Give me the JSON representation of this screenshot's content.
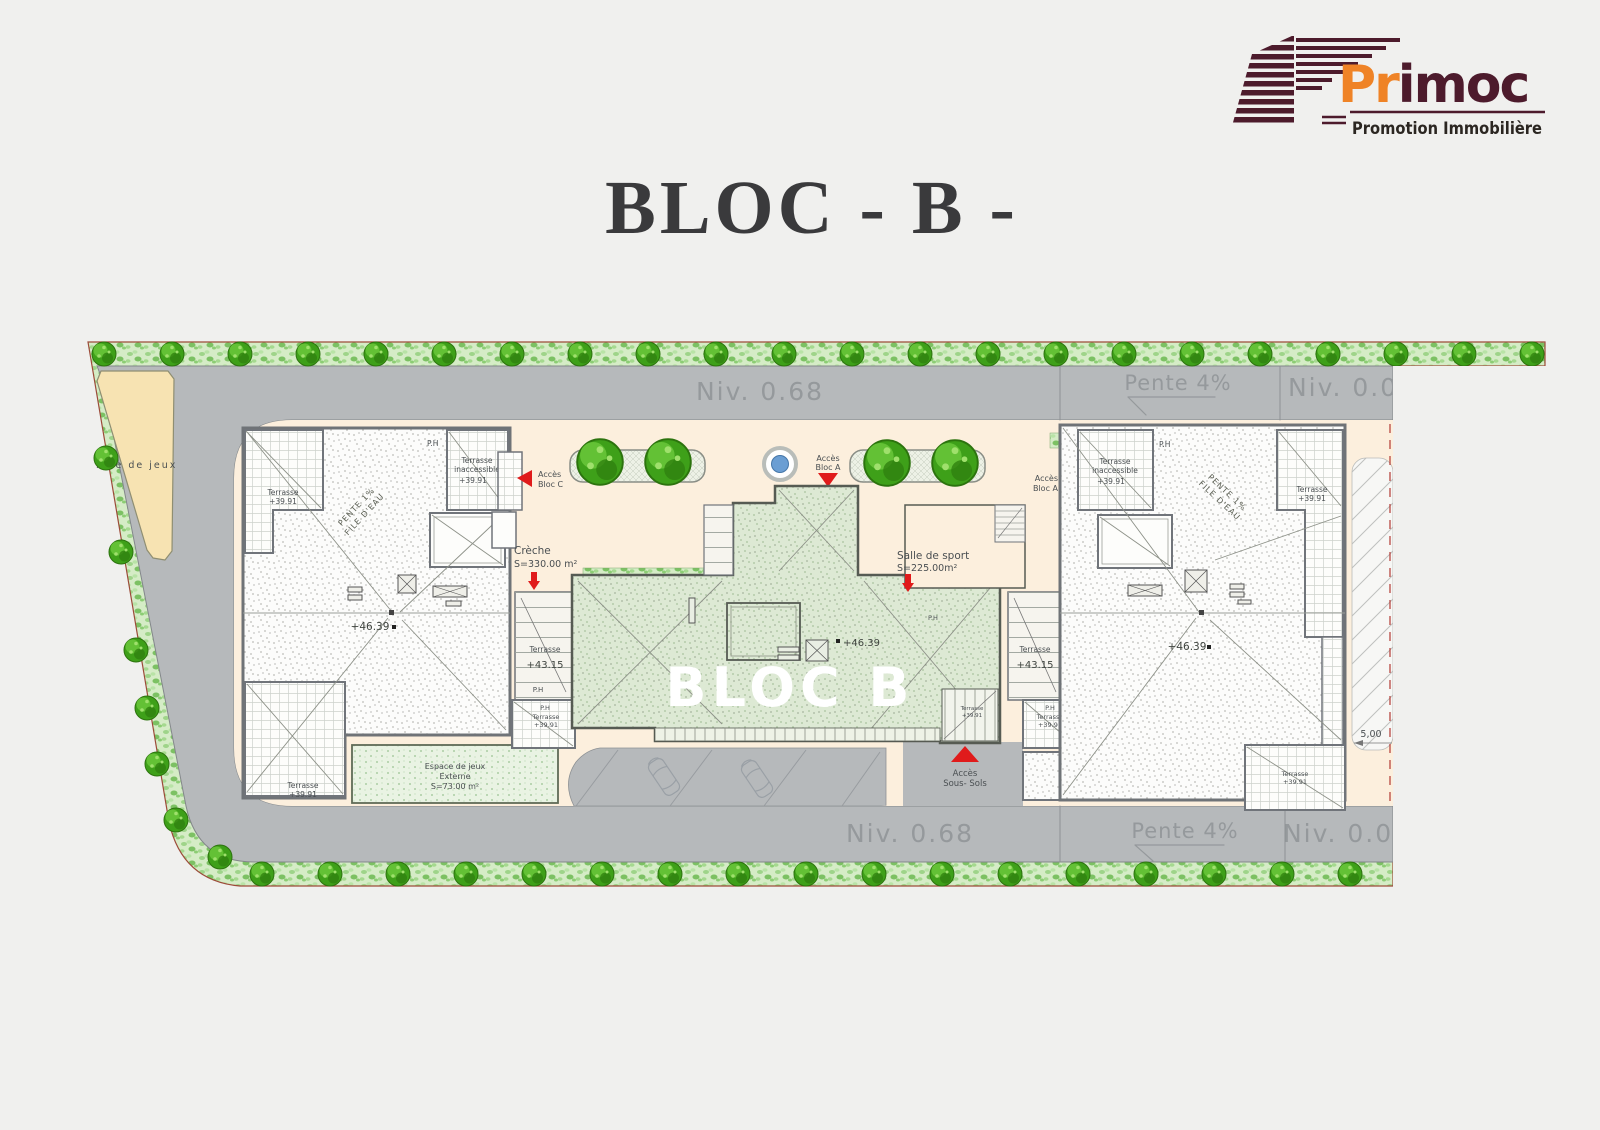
{
  "title": "BLOC - B -",
  "logo": {
    "brand_prefix": "Pr",
    "brand_suffix": "imoc",
    "tagline": "Promotion Immobilière"
  },
  "colors": {
    "maroon": "#4d1b2c",
    "orange": "#ef8326",
    "red": "#e01b1b",
    "road": "#b6b9bb",
    "cream": "#fcefdd",
    "site_green": "#d5ecc6",
    "bloc_green": "#dde9d4",
    "fountain_blue": "#6b9ed3",
    "tree_green": "#3ea019",
    "title_ink": "#3a3a3c"
  },
  "roads": {
    "top": {
      "left": "Niv. 0.68",
      "slope": "Pente 4%",
      "right": "Niv. 0.00"
    },
    "bottom": {
      "left": "Niv. 0.68",
      "slope": "Pente 4%",
      "right": "Niv. 0.00"
    }
  },
  "areas": {
    "aire_de_jeux": "Aire de jeux",
    "bloc_b": "BLOC B",
    "creche": {
      "l1": "Crèche",
      "l2": "S=330.00 m²"
    },
    "sport": {
      "l1": "Salle de sport",
      "l2": "S=225.00m²"
    },
    "espace": {
      "l1": "Espace de jeux",
      "l2": "Externe",
      "l3": "S=73.00 m²"
    }
  },
  "access": {
    "bloc_c": {
      "l1": "Accès",
      "l2": "Bloc C"
    },
    "bloc_a_center": {
      "l1": "Accès",
      "l2": "Bloc A"
    },
    "bloc_a_right": {
      "l1": "Accès",
      "l2": "Bloc A"
    },
    "sous_sols": {
      "l1": "Accès",
      "l2": "Sous- Sols"
    }
  },
  "levels": {
    "v4639": "+46.39",
    "v4315": "+43.15",
    "v3991": "+39.91"
  },
  "labels": {
    "terrasse": "Terrasse",
    "inaccessible": "inaccessible",
    "ph": "P.H",
    "pente1": "PENTE 1%",
    "file_eau": "FILE D'EAU",
    "dim_5": "5,00"
  }
}
